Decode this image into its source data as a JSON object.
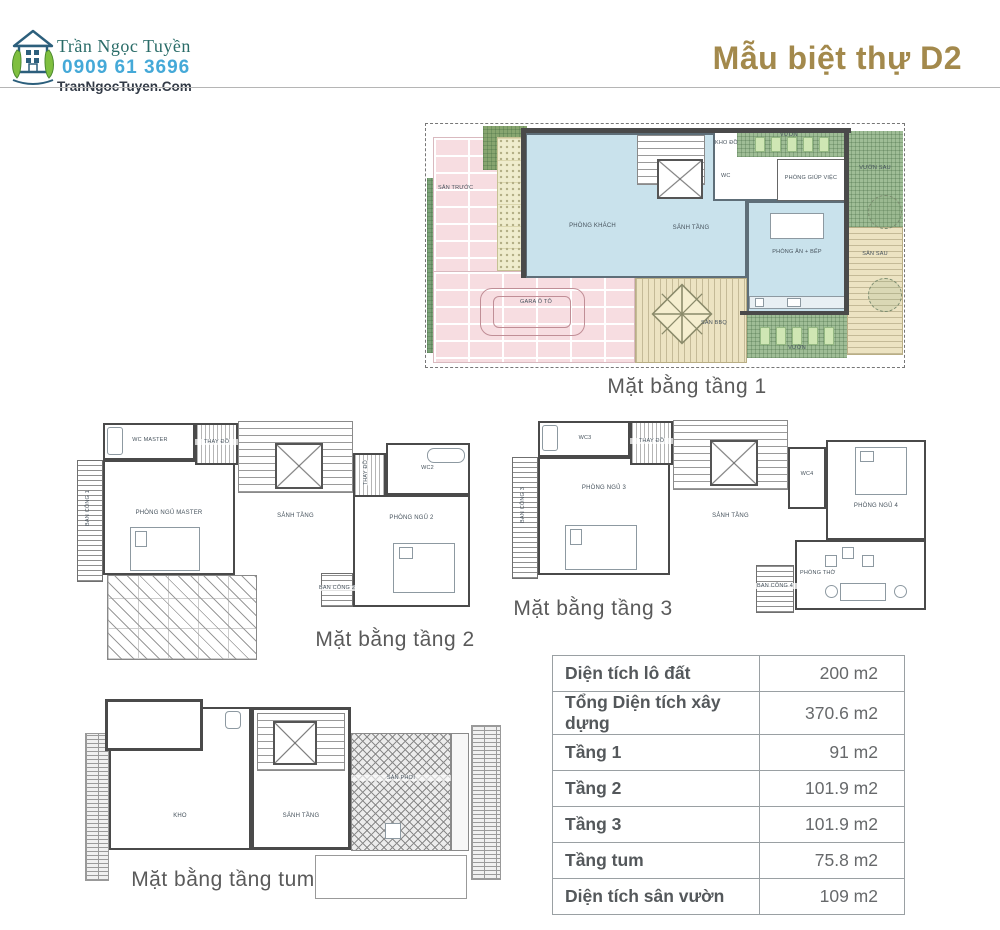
{
  "header": {
    "brand_name": "Trần Ngọc Tuyền",
    "brand_phone": "0909 61 3696",
    "brand_site": "TranNgocTuyen.Com",
    "title": "Mẫu biệt thự D2"
  },
  "colors": {
    "accent_gold": "#a3894c",
    "brand_teal": "#2a6c68",
    "brand_blue": "#45a9d8",
    "room_blue": "#c9e2ec",
    "brick_pink": "#f7dde1",
    "garden_green": "#9fbd96",
    "deck_tan": "#ece3c2"
  },
  "plans": {
    "floor1": {
      "caption": "Mặt bằng tầng 1",
      "labels": {
        "san_truoc": "SÂN TRƯỚC",
        "phong_khach": "PHÒNG KHÁCH",
        "sanh_tang": "SẢNH TẦNG",
        "kho_do": "KHO ĐỒ",
        "wc": "WC",
        "phong_giup_viec": "PHÒNG GIÚP VIỆC",
        "vuon_top": "VƯỜN",
        "vuon_sau": "VƯỜN SAU",
        "san_sau": "SÂN SAU",
        "phong_an_bep": "PHÒNG ĂN + BẾP",
        "gara_oto": "GARA Ô TÔ",
        "san_bbq": "SÂN BBQ",
        "vuon_bottom": "VƯỜN"
      }
    },
    "floor2": {
      "caption": "Mặt bằng tầng 2",
      "labels": {
        "ban_cong_1": "BAN CÔNG 1",
        "wc_master": "WC MASTER",
        "thay_do_1": "THAY ĐỒ",
        "phong_ngu_master": "PHÒNG NGỦ MASTER",
        "sanh_tang": "SẢNH TẦNG",
        "thay_do_2": "THAY ĐỒ",
        "wc2": "WC2",
        "phong_ngu_2": "PHÒNG NGỦ 2",
        "ban_cong_2": "BAN CÔNG 2"
      }
    },
    "floor3": {
      "caption": "Mặt bằng tầng 3",
      "labels": {
        "ban_cong_3": "BAN CÔNG 3",
        "wc3": "WC3",
        "thay_do": "THAY ĐỒ",
        "phong_ngu_3": "PHÒNG NGỦ 3",
        "sanh_tang": "SẢNH TẦNG",
        "wc4": "WC4",
        "phong_ngu_4": "PHÒNG NGỦ 4",
        "phong_tho": "PHÒNG THỜ",
        "ban_cong_4": "BAN CÔNG 4"
      }
    },
    "tum": {
      "caption": "Mặt bằng tầng tum",
      "labels": {
        "kho": "KHO",
        "sanh_tang": "SẢNH TẦNG",
        "san_phoi": "SÂN PHƠI"
      }
    }
  },
  "area_table": {
    "rows": [
      {
        "label": "Diện tích lô đất",
        "value": "200 m2"
      },
      {
        "label": "Tổng Diện tích xây dựng",
        "value": "370.6 m2"
      },
      {
        "label": "Tầng 1",
        "value": "91 m2"
      },
      {
        "label": "Tầng 2",
        "value": "101.9 m2"
      },
      {
        "label": "Tầng 3",
        "value": "101.9 m2"
      },
      {
        "label": "Tầng tum",
        "value": "75.8 m2"
      },
      {
        "label": "Diện tích sân vườn",
        "value": "109 m2"
      }
    ]
  }
}
